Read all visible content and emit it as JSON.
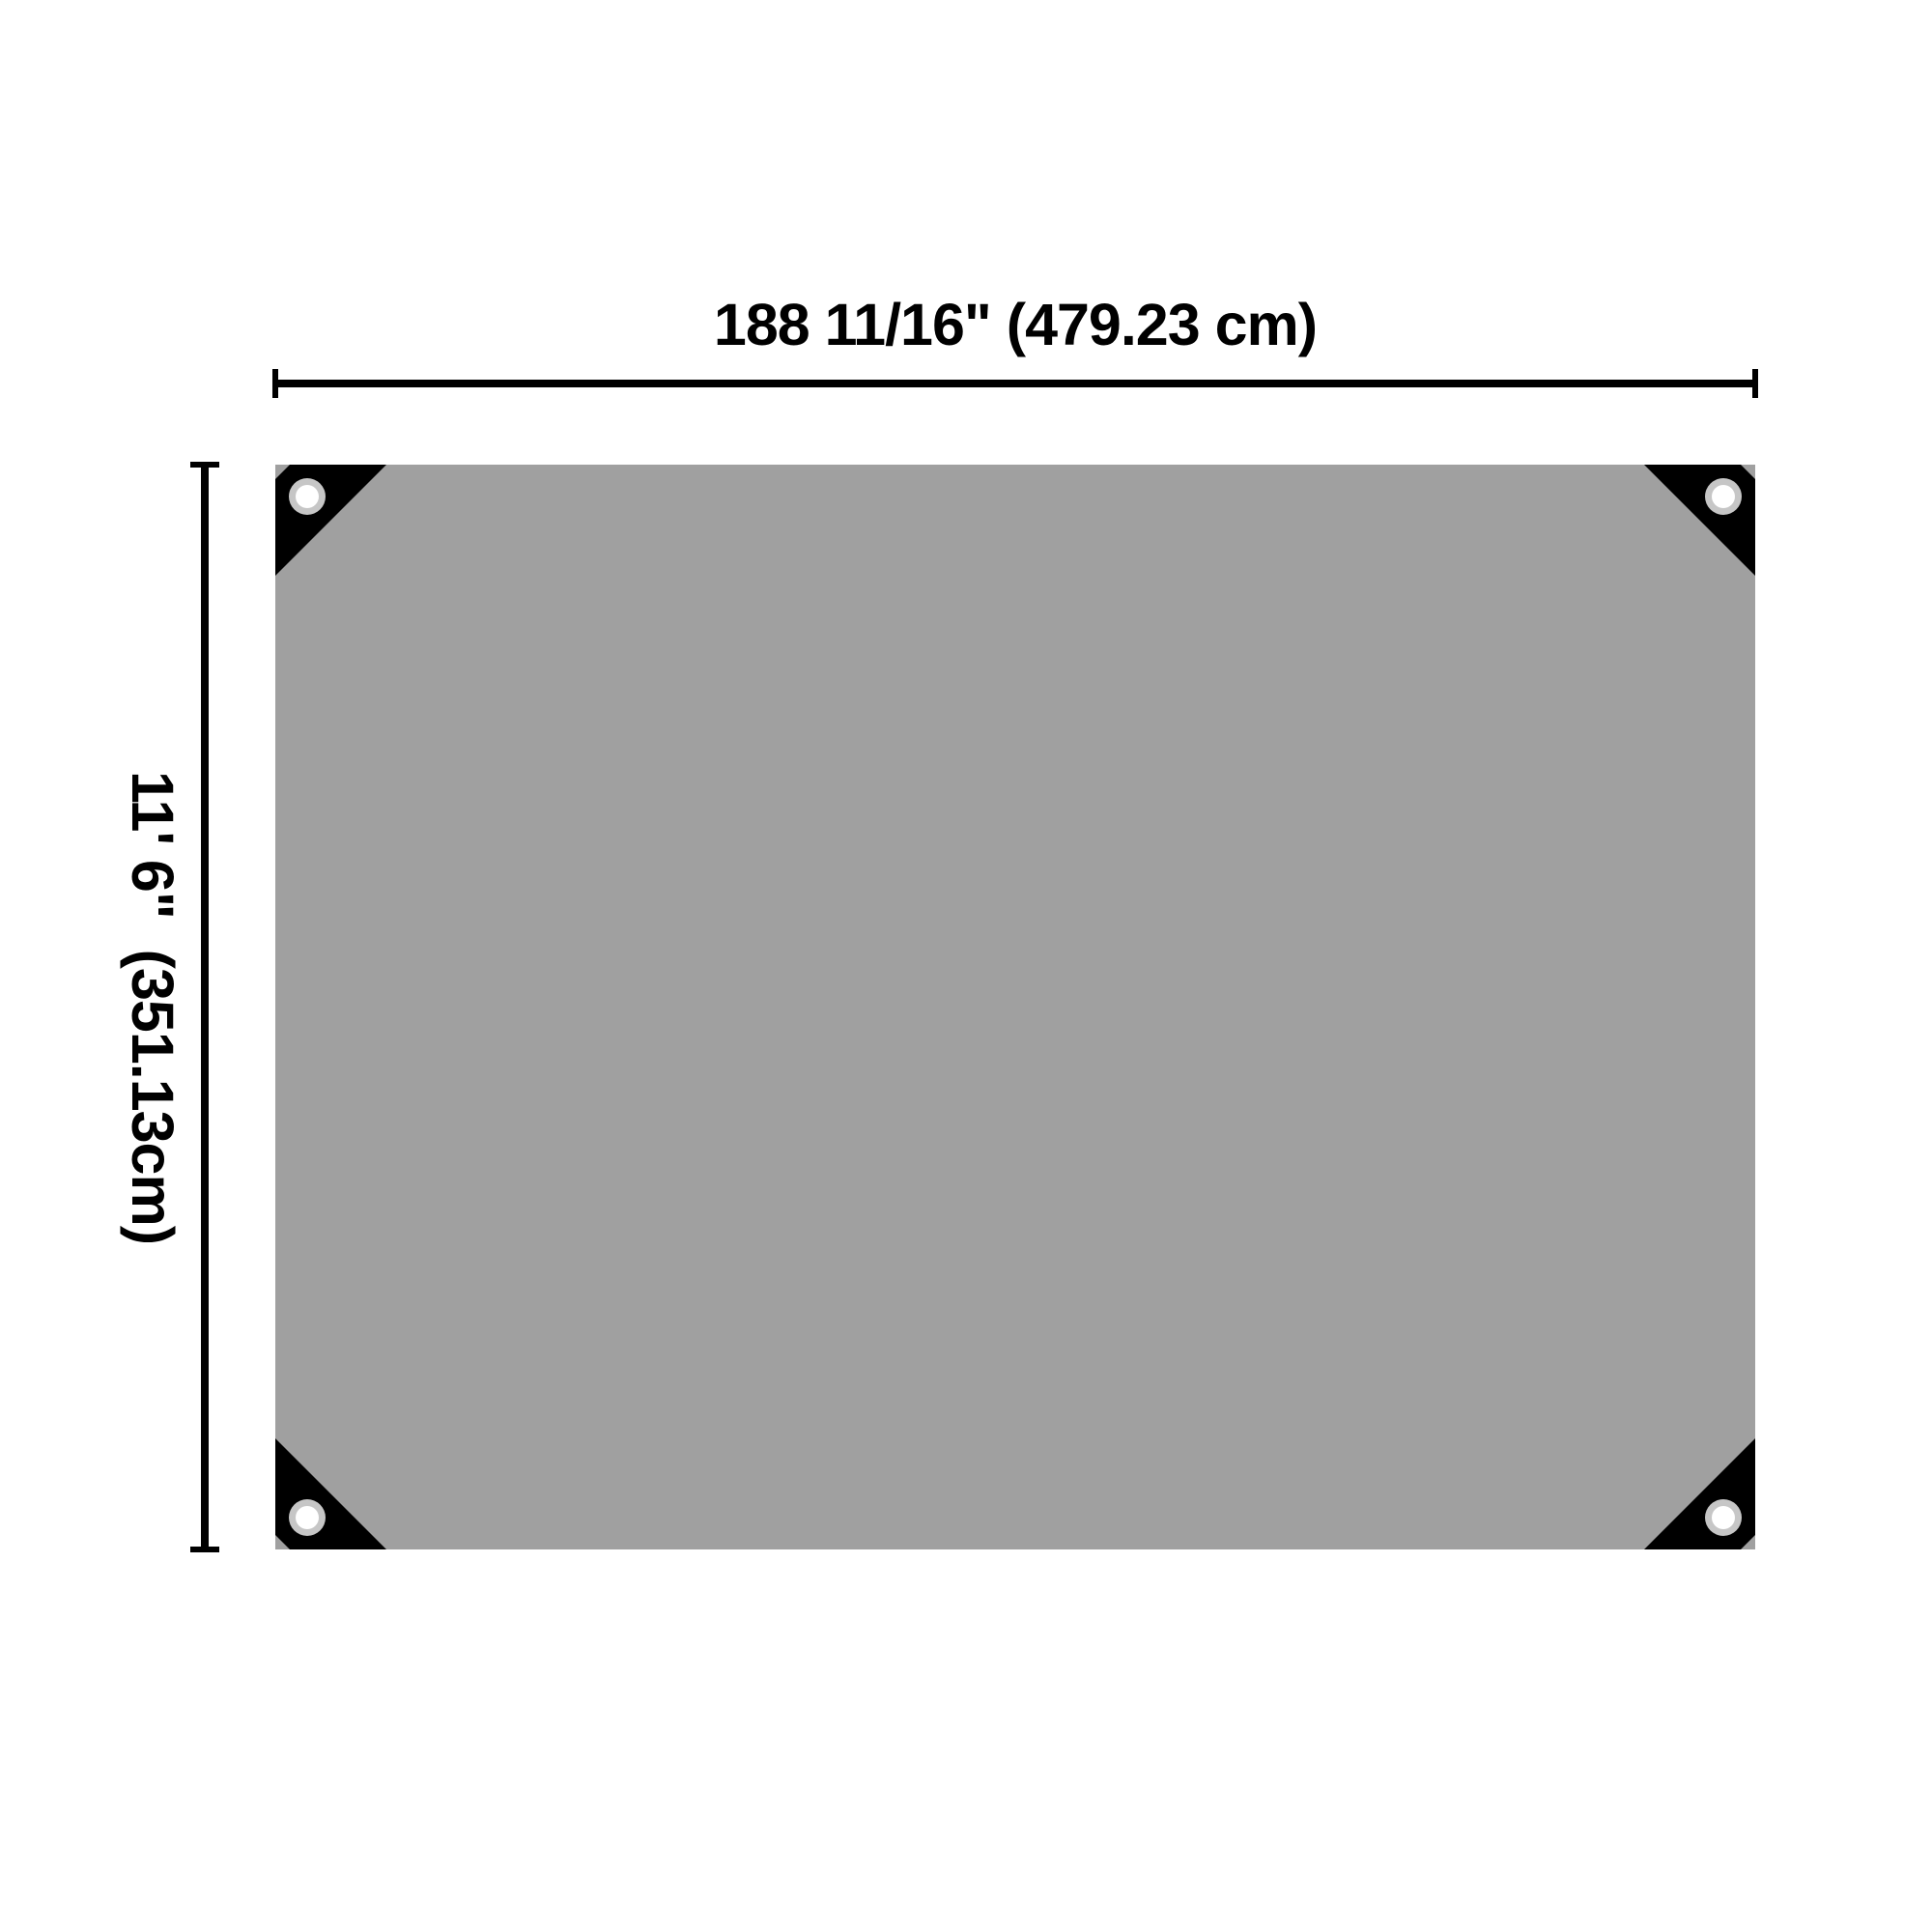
{
  "diagram": {
    "type": "product-dimension-diagram",
    "subject": "tarp-top-view",
    "width_label": "188 11/16\" (479.23 cm)",
    "height_label": "11' 6\"  (351.13cm)",
    "grommets": [
      "top-left",
      "top-right",
      "bottom-left",
      "bottom-right"
    ],
    "colors": {
      "background": "#ffffff",
      "tarp": "#a0a0a0",
      "corner": "#000000",
      "grommet_ring": "#c6c6c6",
      "grommet_hole": "#ffffff",
      "dimension": "#000000"
    }
  }
}
